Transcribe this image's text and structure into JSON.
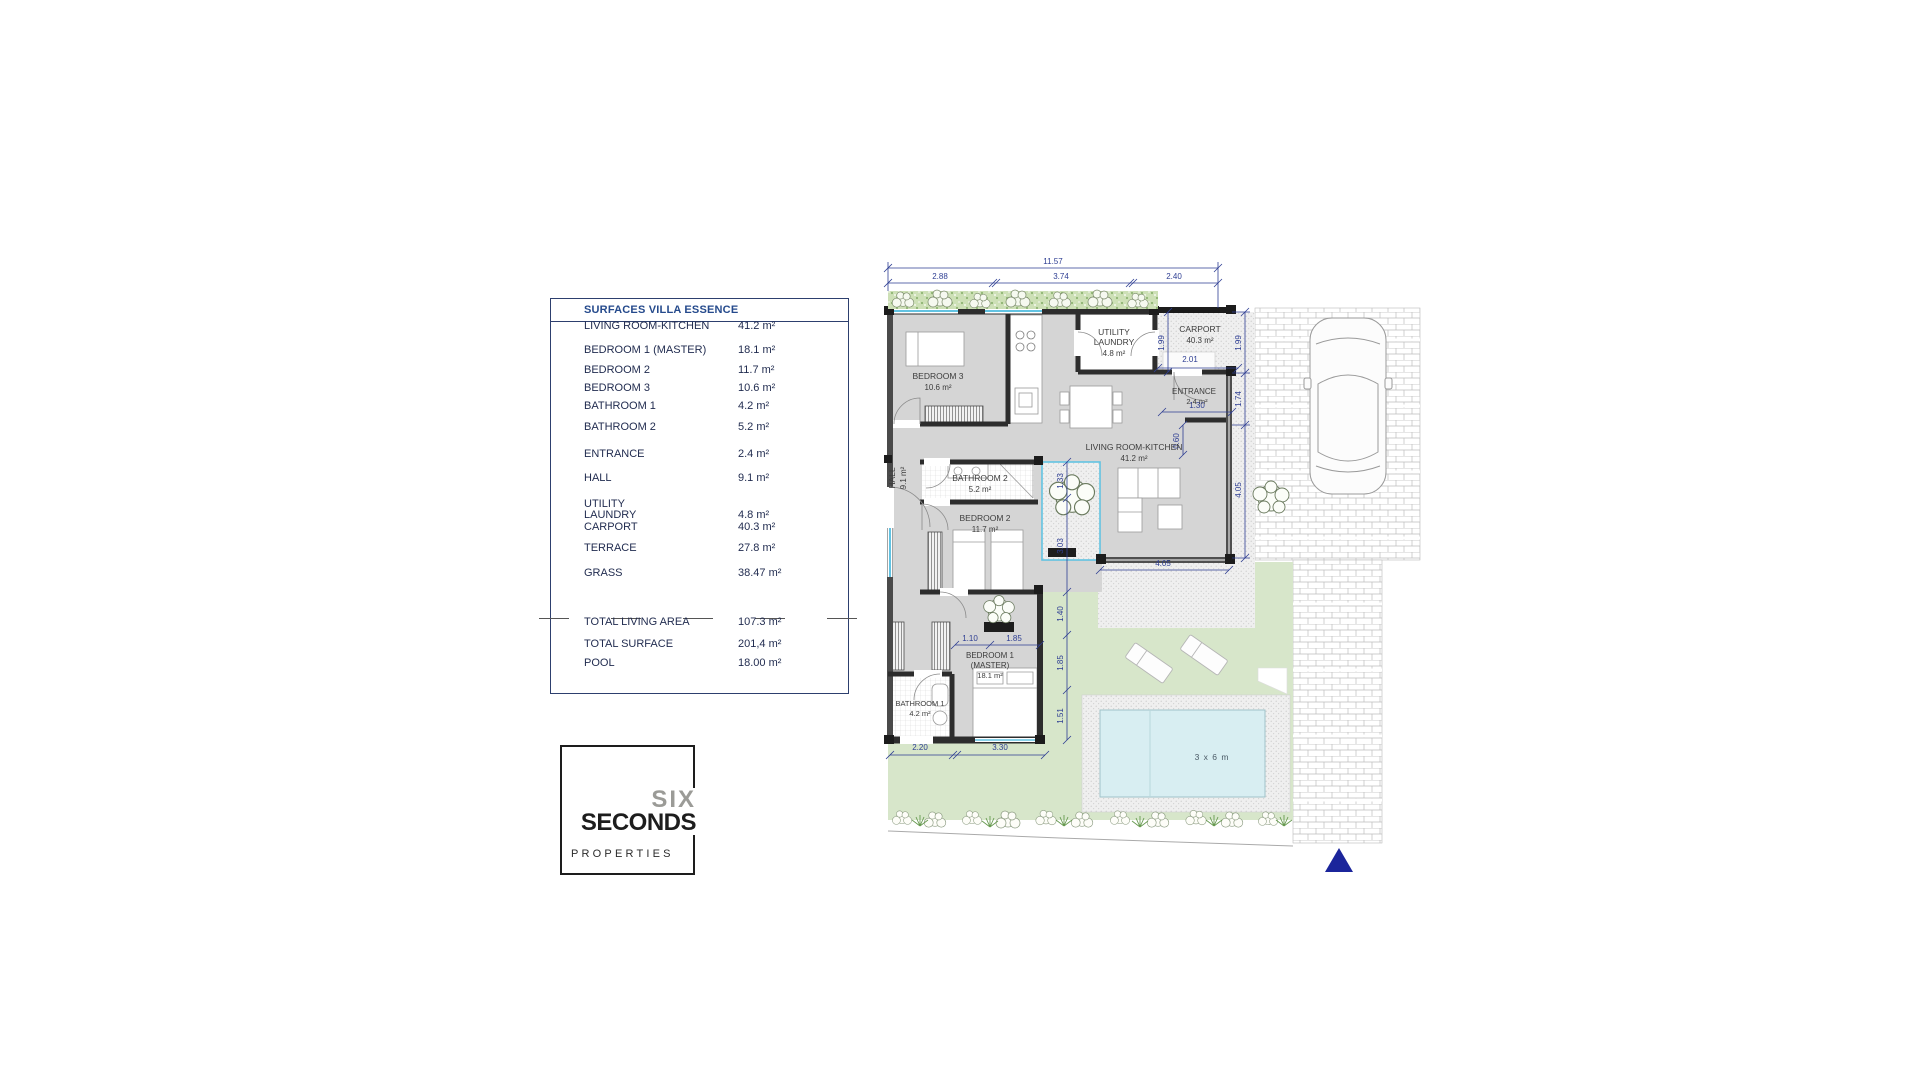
{
  "table": {
    "title": "SURFACES VILLA ESSENCE",
    "rows": [
      {
        "label": "LIVING ROOM-KITCHEN",
        "value": "41.2 m²"
      },
      {
        "label": "BEDROOM 1 (MASTER)",
        "value": "18.1 m²"
      },
      {
        "label": "BEDROOM 2",
        "value": "11.7 m²"
      },
      {
        "label": "BEDROOM 3",
        "value": "10.6 m²"
      },
      {
        "label": "BATHROOM 1",
        "value": "4.2 m²"
      },
      {
        "label": "BATHROOM 2",
        "value": "5.2 m²"
      },
      {
        "label": "ENTRANCE",
        "value": "2.4 m²"
      },
      {
        "label": "HALL",
        "value": "9.1 m²"
      },
      {
        "label": "UTILITY\nLAUNDRY",
        "value": "4.8 m²"
      },
      {
        "label": "CARPORT",
        "value": "40.3 m²"
      },
      {
        "label": "TERRACE",
        "value": "27.8 m²"
      },
      {
        "label": "GRASS",
        "value": "38.47 m²"
      }
    ],
    "totals": [
      {
        "label": "TOTAL LIVING AREA",
        "value": "107.3 m²"
      },
      {
        "label": "TOTAL SURFACE",
        "value": "201,4 m²"
      },
      {
        "label": "POOL",
        "value": "18.00 m²"
      }
    ]
  },
  "logo": {
    "line1": "SIX",
    "line2": "SECONDS",
    "line3": "PROPERTIES"
  },
  "plan": {
    "rooms": {
      "bedroom3": {
        "name": "BEDROOM 3",
        "area": "10.6 m²"
      },
      "utility": {
        "name": "UTILITY",
        "name2": "LAUNDRY",
        "area": "4.8 m²"
      },
      "carport": {
        "name": "CARPORT",
        "area": "40.3 m²"
      },
      "entrance": {
        "name": "ENTRANCE",
        "area": "2.4 m²"
      },
      "living": {
        "name": "LIVING ROOM-KITCHEN",
        "area": "41.2 m²"
      },
      "hall": {
        "name": "HALL",
        "area": "9.1 m²"
      },
      "bathroom2": {
        "name": "BATHROOM 2",
        "area": "5.2 m²"
      },
      "bedroom2": {
        "name": "BEDROOM 2",
        "area": "11.7 m²"
      },
      "bedroom1": {
        "name": "BEDROOM 1",
        "name2": "(MASTER)",
        "area": "18.1 m²"
      },
      "bathroom1": {
        "name": "BATHROOM 1",
        "area": "4.2 m²"
      },
      "pool": {
        "label": "3 x 6 m"
      }
    },
    "dims": {
      "overall": "11.57",
      "top": [
        "2.88",
        "3.74",
        "2.40"
      ],
      "right": [
        "1.99",
        "1.74",
        "4.05"
      ],
      "carport_height": "1.99",
      "carport_width": "2.01",
      "entrance_width": "1.30",
      "entrance_depth": "0.60",
      "left_col": [
        "1.33",
        "3.03",
        "1.40",
        "1.85",
        "1.51"
      ],
      "bed1": [
        "1.10",
        "1.85"
      ],
      "bottom": [
        "2.20",
        "3.30"
      ],
      "terrace": "4.05"
    },
    "colors": {
      "dimension": "#2e3e93",
      "window": "#62c3e2",
      "north_arrow": "#1b259b",
      "wall": "#2d2d2d",
      "floor": "#d5d5d5",
      "grass": "#d7e6ca",
      "pool": "#d8eef2"
    }
  }
}
